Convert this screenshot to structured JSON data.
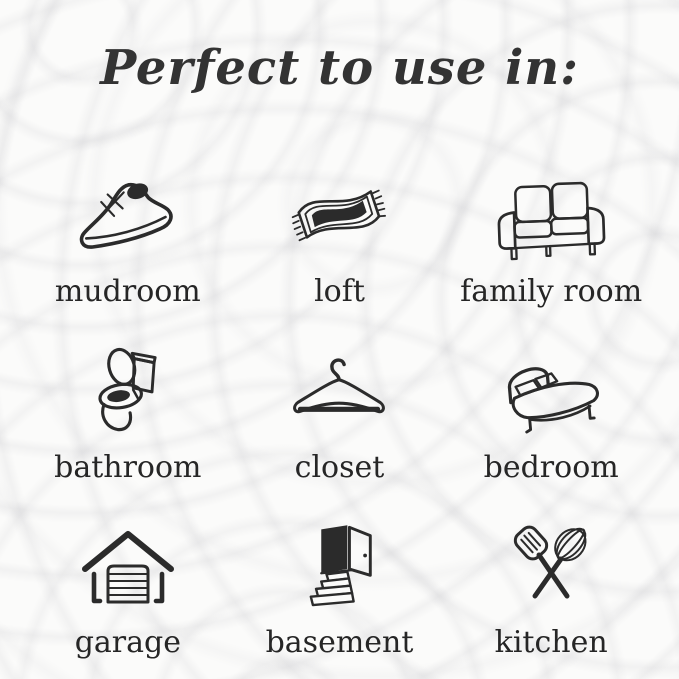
{
  "title": "Perfect to use in:",
  "colors": {
    "ink": "#2b2b2b",
    "background": "#fbfbfa",
    "title_text": "#333333",
    "label_text": "#262626"
  },
  "grid": {
    "items": [
      {
        "label": "mudroom",
        "icon": "sneaker-icon"
      },
      {
        "label": "loft",
        "icon": "rug-icon"
      },
      {
        "label": "family room",
        "icon": "sofa-icon"
      },
      {
        "label": "bathroom",
        "icon": "toilet-icon"
      },
      {
        "label": "closet",
        "icon": "hanger-icon"
      },
      {
        "label": "bedroom",
        "icon": "bed-icon"
      },
      {
        "label": "garage",
        "icon": "garage-icon"
      },
      {
        "label": "basement",
        "icon": "basement-door-icon"
      },
      {
        "label": "kitchen",
        "icon": "utensils-icon"
      }
    ]
  }
}
